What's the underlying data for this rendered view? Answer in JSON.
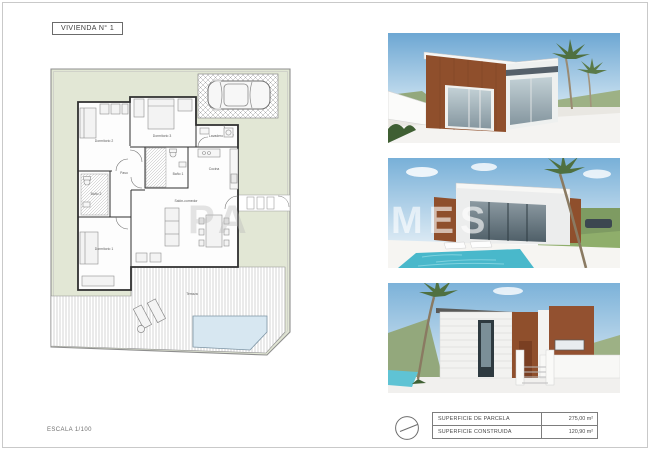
{
  "sheet": {
    "title": "VIVIENDA N° 1",
    "scale_label": "ESCALA 1/100",
    "watermark_left": "PA",
    "watermark_right": "MES"
  },
  "plan": {
    "labels": {
      "dormitorio1": "Dormitorio 1",
      "dormitorio2": "Dormitorio 2",
      "dormitorio3": "Dormitorio 3",
      "lavadero": "Lavadero",
      "cocina": "Cocina",
      "paso": "Paso",
      "bano1": "Baño 1",
      "bano2": "Baño 2",
      "salon": "Salón-comedor",
      "terraza": "Terraza"
    }
  },
  "summary_table": {
    "rows": [
      {
        "label": "SUPERFICIE DE PARCELA",
        "value": "275,00 m²"
      },
      {
        "label": "SUPERFICIE CONSTRUIDA",
        "value": "120,90 m²"
      }
    ]
  },
  "colors": {
    "garden_green": "#e2e7d5",
    "pool_plan_blue": "#d7e7f1",
    "pool_render_aqua": "#49b8cb",
    "wood_brown": "#8f4f2c",
    "sky_blue": "#74abd4",
    "wall_line": "#2f2f2f"
  }
}
